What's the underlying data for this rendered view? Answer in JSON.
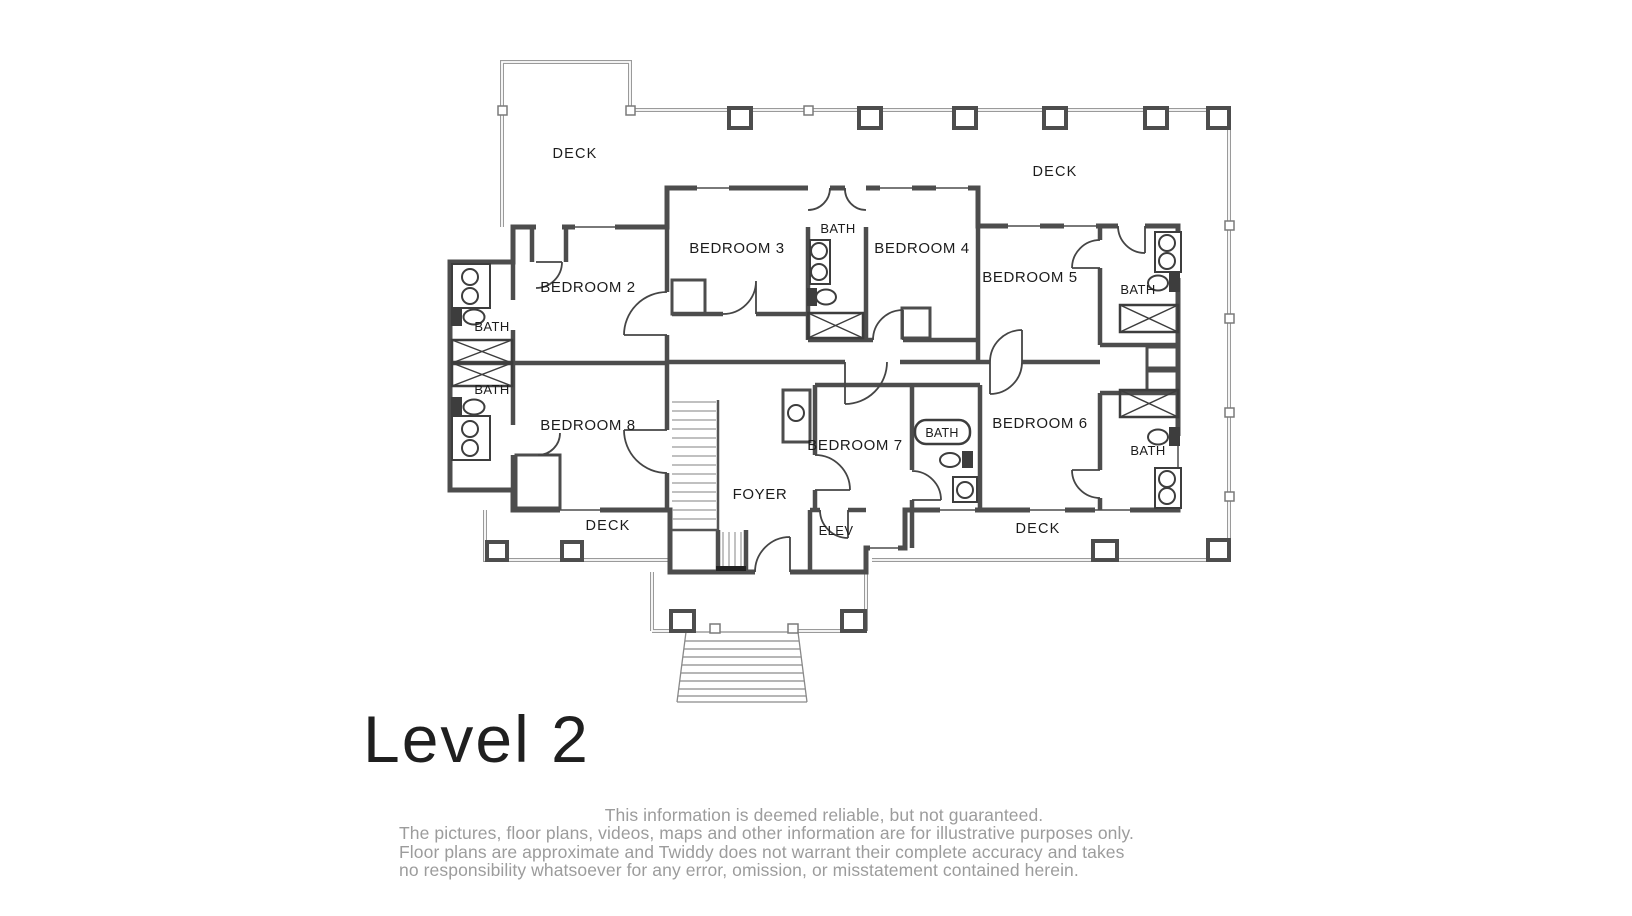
{
  "floor_plan": {
    "title": "Level 2",
    "labels": {
      "deck_top_left": "DECK",
      "deck_top_right": "DECK",
      "deck_bottom_left": "DECK",
      "deck_bottom_right": "DECK",
      "bedroom2": "BEDROOM 2",
      "bedroom3": "BEDROOM 3",
      "bedroom4": "BEDROOM 4",
      "bedroom5": "BEDROOM 5",
      "bedroom6": "BEDROOM 6",
      "bedroom7": "BEDROOM 7",
      "bedroom8": "BEDROOM 8",
      "bath_center": "BATH",
      "bath_left_upper": "BATH",
      "bath_left_lower": "BATH",
      "bath_right_upper": "BATH",
      "bath_right_lower": "BATH",
      "bath_bedroom7": "BATH",
      "foyer": "FOYER",
      "elevator": "ELEV"
    },
    "disclaimer_lines": [
      "This information is deemed reliable, but not guaranteed.",
      "The pictures, floor plans, videos, maps and other information are for illustrative purposes only.",
      "Floor plans are approximate and Twiddy does not warrant their complete accuracy and takes",
      "no responsibility whatsoever for any error, omission, or misstatement contained herein."
    ]
  },
  "colors": {
    "background": "#ffffff",
    "wall": "#4d4d4d",
    "railing": "#9a9a9a",
    "fixture": "#3d3d3d",
    "label_text": "#1c1c1c",
    "disclaimer_text": "#9c9c9c"
  }
}
